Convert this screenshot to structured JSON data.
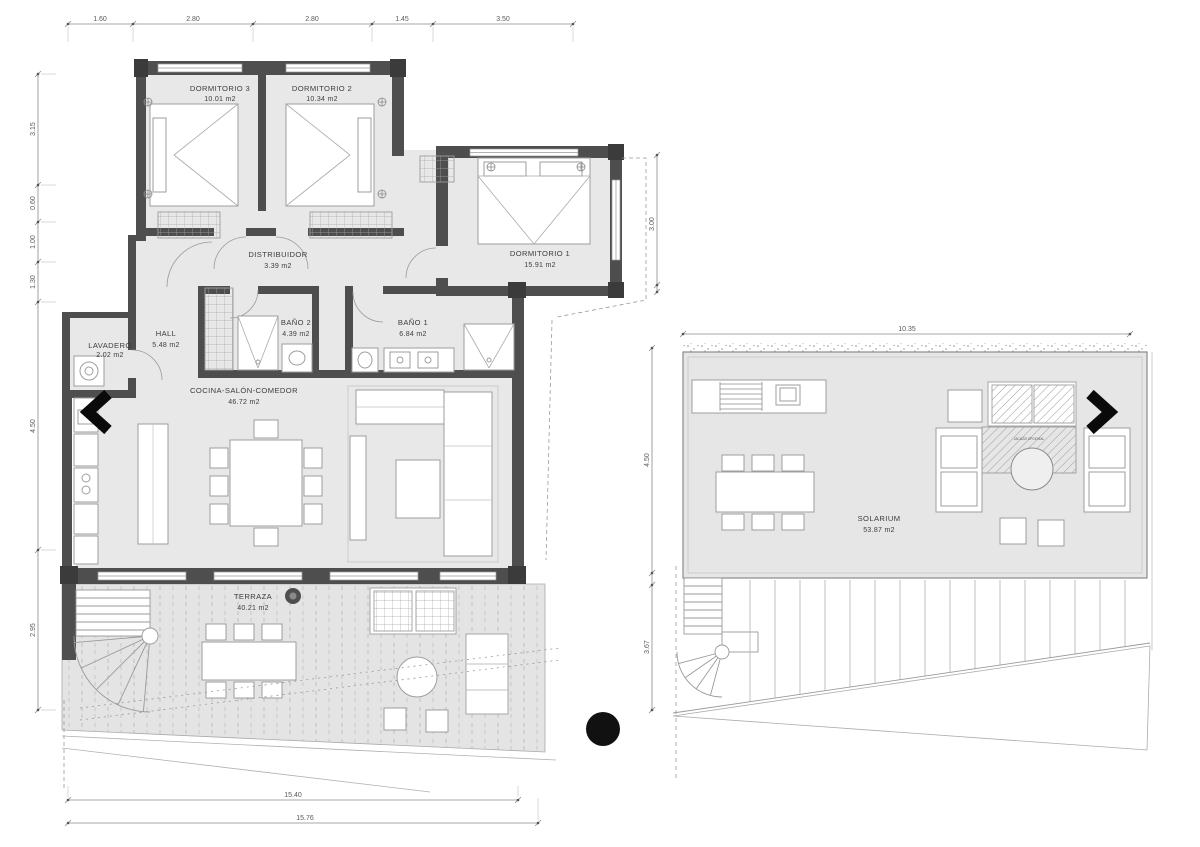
{
  "colors": {
    "wall": "#4e4e4e",
    "post": "#3b3b3b",
    "room_fill": "#e8e8e8",
    "terrace_fill": "#e4e4e4",
    "solarium_fill": "#e6e6e6",
    "furniture_stroke": "#9e9e9e",
    "dim_line": "#8a8a8a",
    "nav_arrow": "#0a0a0a"
  },
  "left_plan": {
    "rooms": {
      "dormitorio3": {
        "label": "DORMITORIO 3",
        "area": "10.01 m2"
      },
      "dormitorio2": {
        "label": "DORMITORIO 2",
        "area": "10.34 m2"
      },
      "dormitorio1": {
        "label": "DORMITORIO 1",
        "area": "15.91 m2"
      },
      "distribuidor": {
        "label": "DISTRIBUIDOR",
        "area": "3.39 m2"
      },
      "hall": {
        "label": "HALL",
        "area": "5.48 m2"
      },
      "lavadero": {
        "label": "LAVADERO",
        "area": "2.02 m2"
      },
      "bano2": {
        "label": "BAÑO 2",
        "area": "4.39 m2"
      },
      "bano1": {
        "label": "BAÑO 1",
        "area": "6.84 m2"
      },
      "cocina": {
        "label": "COCINA-SALÓN-COMEDOR",
        "area": "46.72 m2"
      },
      "terraza": {
        "label": "TERRAZA",
        "area": "40.21 m2"
      }
    },
    "dimensions": {
      "top": [
        "1.60",
        "2.80",
        "2.80",
        "1.45",
        "3.50"
      ],
      "left": [
        "3.15",
        "0.60",
        "1.00",
        "1.30",
        "4.50",
        "2.95"
      ],
      "right": [
        "3.00"
      ],
      "bottom": [
        "15.40",
        "15.76"
      ]
    }
  },
  "right_plan": {
    "rooms": {
      "solarium": {
        "label": "SOLARIUM",
        "area": "53.87 m2"
      }
    },
    "annotations": {
      "jacuzzi": "JACUZZI OPCIONAL"
    },
    "dimensions": {
      "top": [
        "10.35"
      ],
      "left": [
        "4.50",
        "3.67"
      ]
    }
  },
  "icons": {
    "prev": "chevron-left",
    "next": "chevron-right",
    "marker": "solid-dot"
  }
}
